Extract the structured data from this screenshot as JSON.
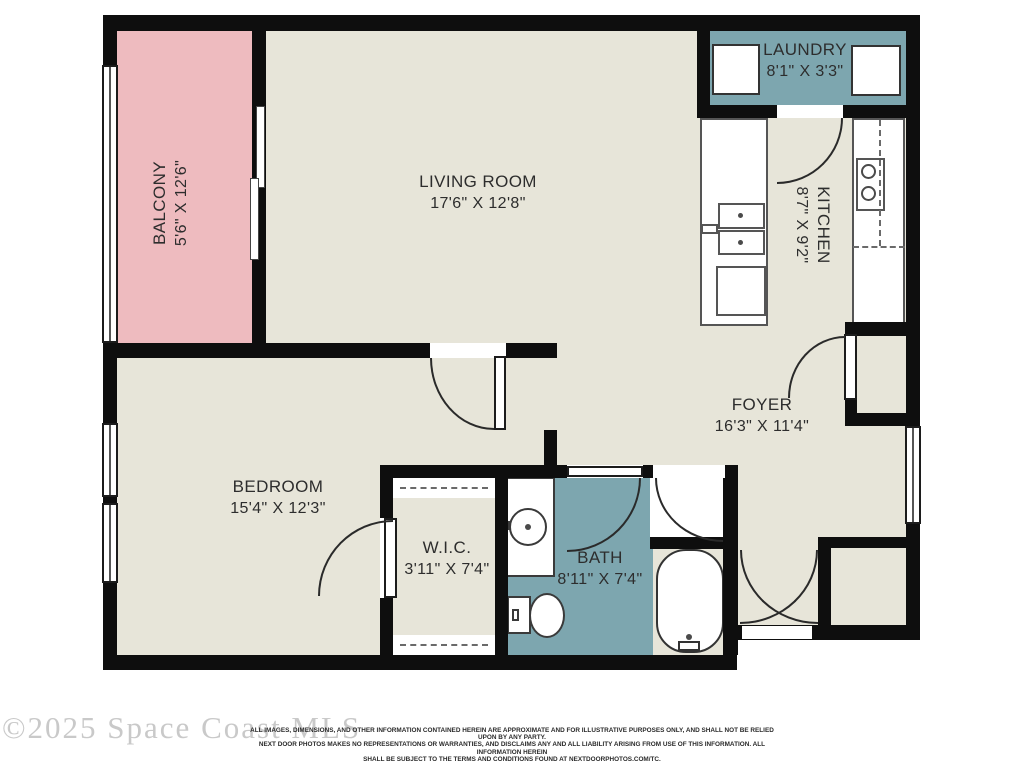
{
  "title": "Apartment floor plan",
  "watermark": "©2025 Space Coast MLS",
  "disclaimer": {
    "line1": "ALL IMAGES, DIMENSIONS, AND OTHER INFORMATION CONTAINED HEREIN ARE APPROXIMATE AND FOR ILLUSTRATIVE PURPOSES ONLY, AND SHALL NOT BE RELIED UPON BY ANY PARTY.",
    "line2": "NEXT DOOR PHOTOS MAKES NO REPRESENTATIONS OR WARRANTIES, AND DISCLAIMS ANY AND ALL LIABILITY ARISING FROM USE OF THIS INFORMATION. ALL INFORMATION HEREIN",
    "line3": "SHALL BE SUBJECT TO THE TERMS AND CONDITIONS FOUND AT NEXTDOORPHOTOS.COM/TC."
  },
  "rooms": [
    {
      "id": "balcony",
      "name": "BALCONY",
      "dims": "5'6\" X 12'6\""
    },
    {
      "id": "living",
      "name": "LIVING ROOM",
      "dims": "17'6\" X 12'8\""
    },
    {
      "id": "laundry",
      "name": "LAUNDRY",
      "dims": "8'1\" X 3'3\""
    },
    {
      "id": "kitchen",
      "name": "KITCHEN",
      "dims": "8'7\" X 9'2\""
    },
    {
      "id": "foyer",
      "name": "FOYER",
      "dims": "16'3\" X 11'4\""
    },
    {
      "id": "bedroom",
      "name": "BEDROOM",
      "dims": "15'4\" X 12'3\""
    },
    {
      "id": "wic",
      "name": "W.I.C.",
      "dims": "3'11\" X 7'4\""
    },
    {
      "id": "bath",
      "name": "BATH",
      "dims": "8'11\" X 7'4\""
    }
  ],
  "colors": {
    "balcony_pink": "#eebbbf",
    "wet_room_teal": "#7da6af",
    "floor_beige": "#e7e5d9",
    "wall_black": "#0e0e0e",
    "page_background": "#ffffff"
  }
}
